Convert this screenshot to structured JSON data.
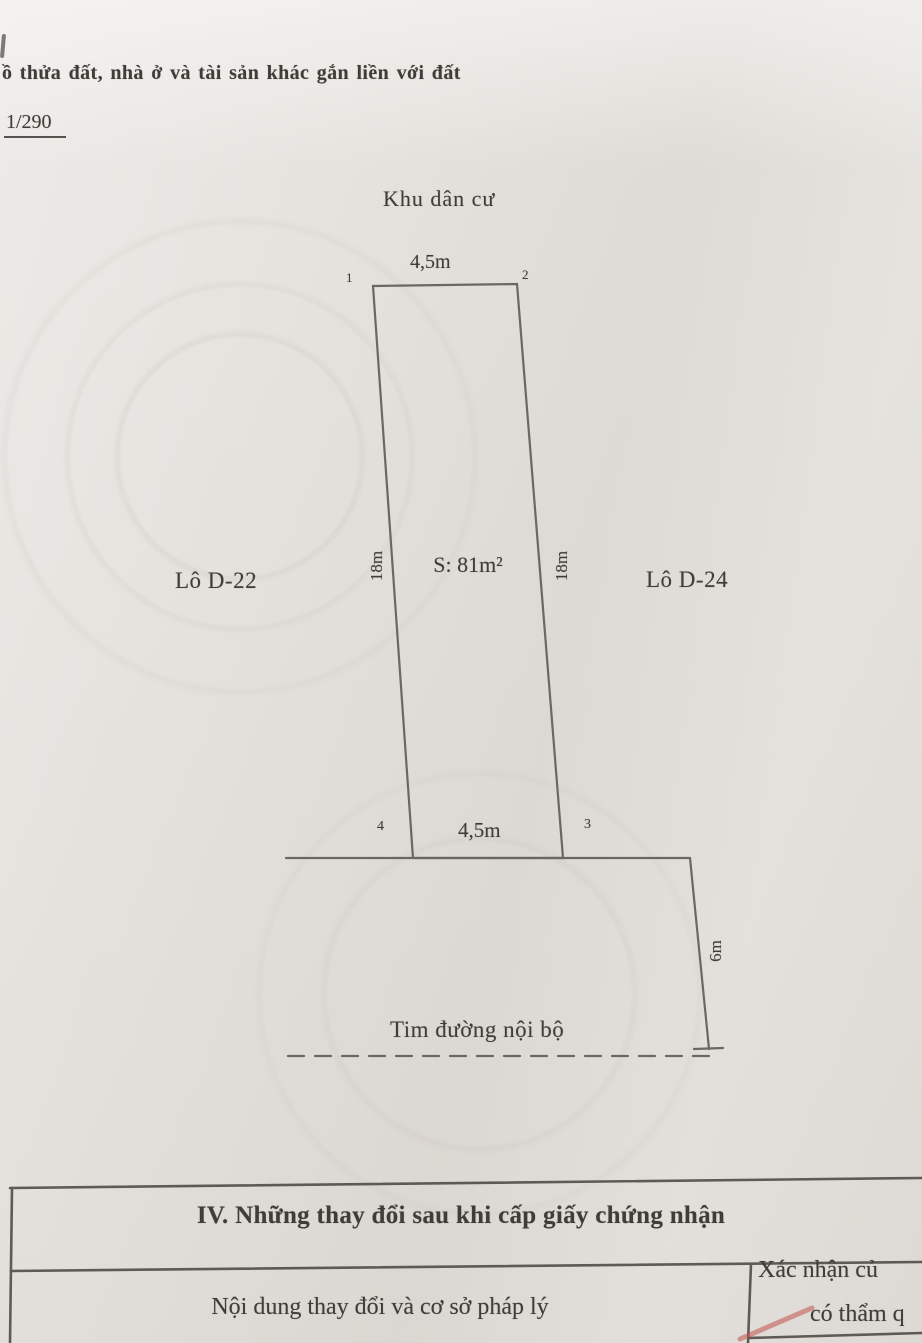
{
  "document": {
    "heading": "ồ thửa đất, nhà ở và tài sản khác gắn liền với đất",
    "scale": "1/290"
  },
  "diagram": {
    "area_label": "Khu dân cư",
    "dim_top": "4,5m",
    "dim_bottom": "4,5m",
    "dim_left": "18m",
    "dim_right": "18m",
    "dim_road": "6m",
    "plot_area": "S: 81m²",
    "lot_left": "Lô D-22",
    "lot_right": "Lô D-24",
    "road_label": "Tim đường nội bộ",
    "corner_1": "1",
    "corner_2": "2",
    "corner_3": "3",
    "corner_4": "4"
  },
  "section_table": {
    "title": "IV. Những thay đổi sau khi cấp giấy chứng nhận",
    "left_header": "Nội dung thay đổi và cơ sở pháp lý",
    "right_header_line1": "Xác nhận củ",
    "right_header_line2": "có thẩm q"
  },
  "colors": {
    "ink": "#3f3c38",
    "line": "#66625c",
    "red_mark": "#c4524e",
    "paper": "#e9e6e2"
  }
}
